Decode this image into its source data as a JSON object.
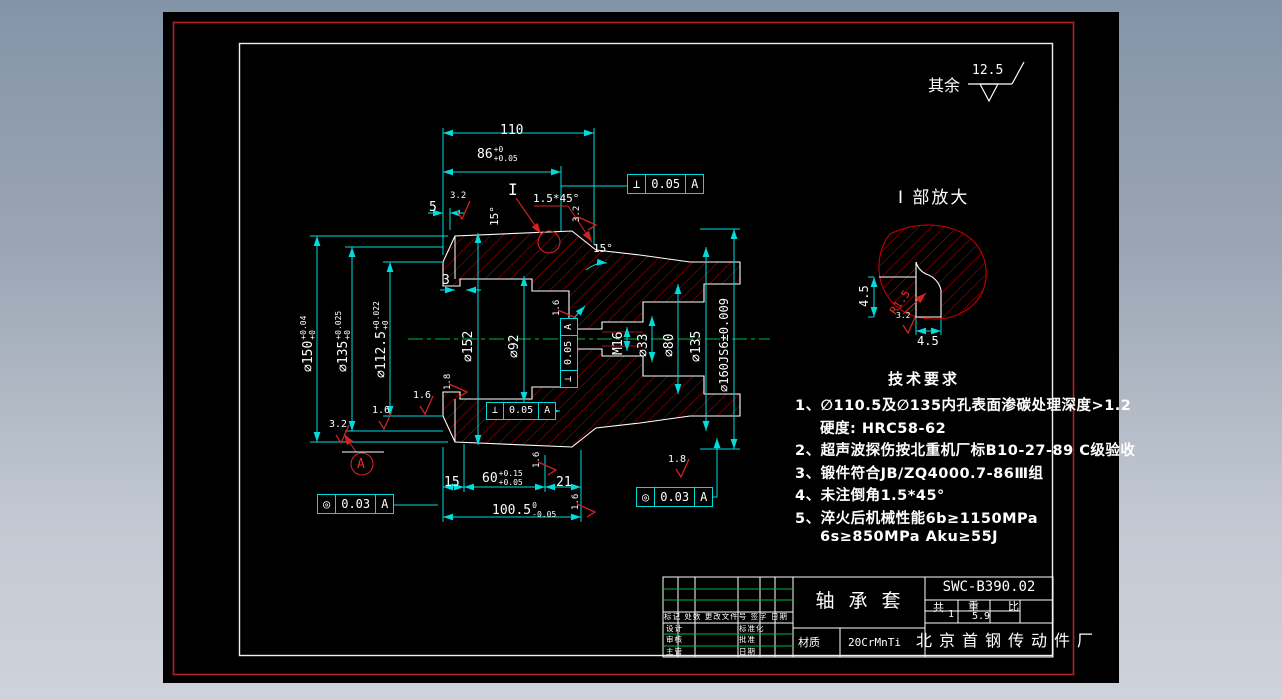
{
  "general_note": {
    "prefix": "其余",
    "value": "12.5"
  },
  "detail_view": {
    "title": "I 部放大",
    "marker": "I",
    "dim_vertical": "4.5",
    "dim_horizontal": "4.5",
    "radius": "R1.5"
  },
  "tech_requirements": {
    "title": "技术要求",
    "lines": [
      "1、∅110.5及∅135内孔表面渗碳处理深度>1.2",
      "硬度: HRC58-62",
      "2、超声波探伤按北重机厂标B10-27-89 C级验收",
      "3、锻件符合JB/ZQ4000.7-86Ⅲ组",
      "4、未注倒角1.5*45°",
      "5、淬火后机械性能6b≥1150MPa",
      "6s≥850MPa Aku≥55J"
    ]
  },
  "dims": {
    "d110": "110",
    "d86": {
      "main": "86",
      "sup": "+0",
      "sub": "+0.05"
    },
    "d5": "5",
    "d3": "3",
    "d15": "15",
    "d60": {
      "main": "60",
      "sup": "+0.15",
      "sub": "+0.05"
    },
    "d21": "21",
    "d100_5": {
      "main": "100.5",
      "sup": "0",
      "sub": "-0.05"
    },
    "d150": {
      "main": "∅150",
      "sup": "+0.04",
      "sub": "+0"
    },
    "d135_left": {
      "main": "∅135",
      "sup": "+0.025",
      "sub": "+0"
    },
    "d112_5": {
      "main": "∅112.5",
      "sup": "+0.022",
      "sub": "+0"
    },
    "d152": "∅152",
    "d92": "∅92",
    "dM16": "M16",
    "d33": "∅33",
    "d80": "∅80",
    "d135_right": "∅135",
    "d160": "∅160JS6±0.009",
    "angle_left": "15°",
    "angle_right": "15°",
    "chamfer": "1.5*45°"
  },
  "fcf": {
    "top": {
      "symbol": "⊥",
      "value": "0.05",
      "datum": "A"
    },
    "mid_vertical": {
      "symbol": "⊥",
      "value": "0.05",
      "datum": "A"
    },
    "mid_bottom": {
      "symbol": "⊥",
      "value": "0.05",
      "datum": "A"
    },
    "bottom_left": {
      "symbol": "◎",
      "value": "0.03",
      "datum": "A"
    },
    "bottom_right": {
      "symbol": "◎",
      "value": "0.03",
      "datum": "A"
    },
    "datum_label": "A"
  },
  "roughness_marks": {
    "r1": "3.2",
    "r2": "3.2",
    "r3": "3.2",
    "r4": "1.6",
    "r5": "1.6",
    "r6": "1.8",
    "r7": "1.6",
    "r8": "1.6",
    "r9": "1.6",
    "r10": "1.8",
    "detail": "3.2"
  },
  "title_block": {
    "drawing_no": "SWC-B390.02",
    "part_name": "轴 承 套",
    "material_label": "材质",
    "material": "20CrMnTi",
    "company": "北京首钢传动件厂",
    "info": {
      "qty_label": "共",
      "qty": "1",
      "weight_label": "重",
      "weight": "5.9",
      "scale_label": "比"
    },
    "rev_header": "标记 处数 更改文件号 签字 日期",
    "rev_rows": [
      [
        "设计",
        "标准化"
      ],
      [
        "审核",
        "批准"
      ],
      [
        "主管",
        "日期"
      ]
    ]
  }
}
